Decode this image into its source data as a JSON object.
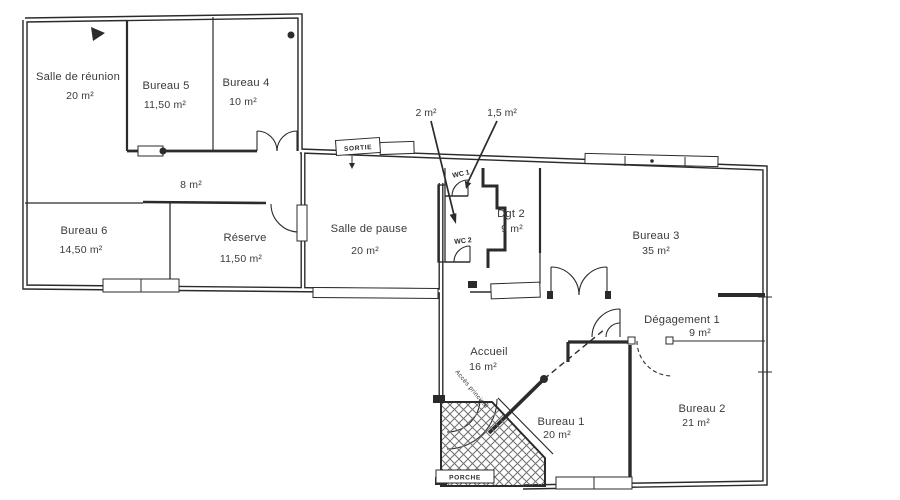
{
  "rooms": [
    {
      "id": "salle-de-reunion",
      "name": "Salle de réunion",
      "area": "20 m²"
    },
    {
      "id": "bureau-5",
      "name": "Bureau 5",
      "area": "11,50 m²"
    },
    {
      "id": "bureau-4",
      "name": "Bureau 4",
      "area": "10 m²"
    },
    {
      "id": "couloir",
      "name": "",
      "area": "8 m²"
    },
    {
      "id": "bureau-6",
      "name": "Bureau 6",
      "area": "14,50 m²"
    },
    {
      "id": "reserve",
      "name": "Réserve",
      "area": "11,50 m²"
    },
    {
      "id": "salle-de-pause",
      "name": "Salle de pause",
      "area": "20 m²"
    },
    {
      "id": "dgt-2",
      "name": "Dgt 2",
      "area": "9 m²"
    },
    {
      "id": "bureau-3",
      "name": "Bureau 3",
      "area": "35 m²"
    },
    {
      "id": "degagement-1",
      "name": "Dégagement 1",
      "area": "9 m²"
    },
    {
      "id": "accueil",
      "name": "Accueil",
      "area": "16 m²"
    },
    {
      "id": "bureau-1",
      "name": "Bureau 1",
      "area": "20 m²"
    },
    {
      "id": "bureau-2",
      "name": "Bureau 2",
      "area": "21 m²"
    }
  ],
  "wc_labels": {
    "wc1": "WC 1",
    "wc2": "WC 2"
  },
  "area_callouts": {
    "wc2": "2 m²",
    "wc1": "1,5 m²"
  },
  "signs": {
    "sortie": "SORTIE",
    "porche": "PORCHE",
    "acces": "Accès principal"
  },
  "colors": {
    "ink": "#2b2b2b",
    "paper": "#ffffff"
  }
}
